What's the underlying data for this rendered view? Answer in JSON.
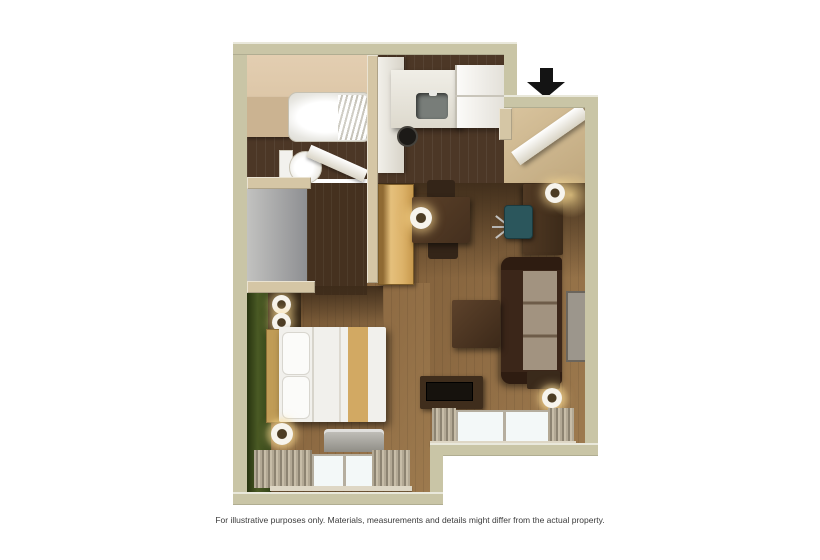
{
  "image_type": "3d-floorplan-rendering",
  "disclaimer": "For illustrative purposes only.  Materials, measurements and details might differ from the actual property.",
  "entry_marker": {
    "icon": "down-arrow-icon",
    "color": "#141414",
    "meaning": "unit entrance"
  },
  "palette": {
    "background": "#ffffff",
    "outer_wall": "#c9c5a6",
    "interior_wall": "#d5c6a5",
    "dark_wood_floor": "#4c3726",
    "light_wood_floor": "#8f6c44",
    "accent_wall_green": "#42511f",
    "vanity_gray": "#9a9a98",
    "sofa_brown": "#3b2619",
    "bedding_white": "#f1f0ec",
    "wardrobe_oak": "#ddb469"
  },
  "rooms": {
    "bathroom": [
      "bathtub",
      "shower-curtain",
      "toilet",
      "door"
    ],
    "kitchen": [
      "counter",
      "sink",
      "cooktop-burner",
      "refrigerator"
    ],
    "entry": [
      "open-door",
      "entrance-arrow"
    ],
    "dressing_area": [
      "double-sink-vanity",
      "closet-floor",
      "wardrobe-cabinet"
    ],
    "work_dining_area": [
      "dining-table",
      "two-chairs",
      "table-lamp",
      "desk",
      "desk-lamp",
      "office-chair"
    ],
    "living_area": [
      "sofa",
      "coffee-table",
      "wall-art",
      "end-table",
      "floor-lamp",
      "tv-console",
      "tv",
      "window"
    ],
    "bedroom": [
      "green-accent-wall",
      "nightstand",
      "two-lamps",
      "bed",
      "pillows",
      "floor-lamp",
      "ptac-ac-unit",
      "window"
    ]
  }
}
